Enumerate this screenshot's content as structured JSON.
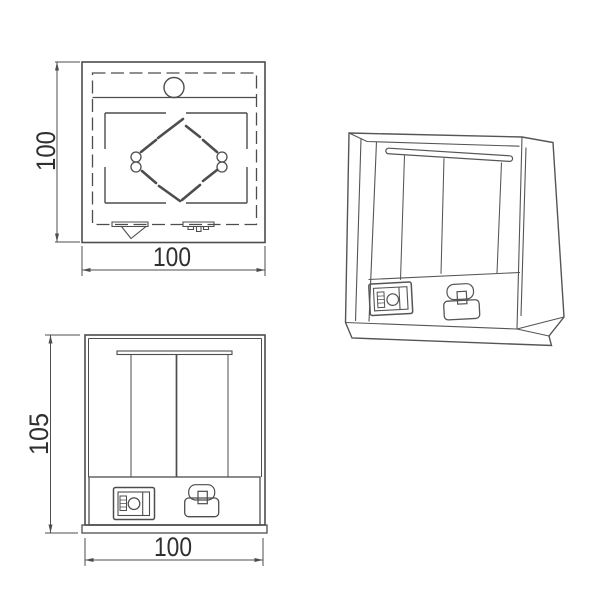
{
  "document": {
    "type": "technical-drawing",
    "subject": "square wall lamp with rocker switch and cord grip",
    "background": "#ffffff"
  },
  "colors": {
    "line": "#4d4d4d",
    "perspective_line": "#555555",
    "text": "#303030"
  },
  "views": {
    "top": {
      "name": "top-view",
      "height_dim": "100",
      "width_dim": "100"
    },
    "front": {
      "name": "front-view",
      "height_dim": "105",
      "width_dim": "100"
    },
    "perspective": {
      "name": "perspective-view"
    }
  }
}
